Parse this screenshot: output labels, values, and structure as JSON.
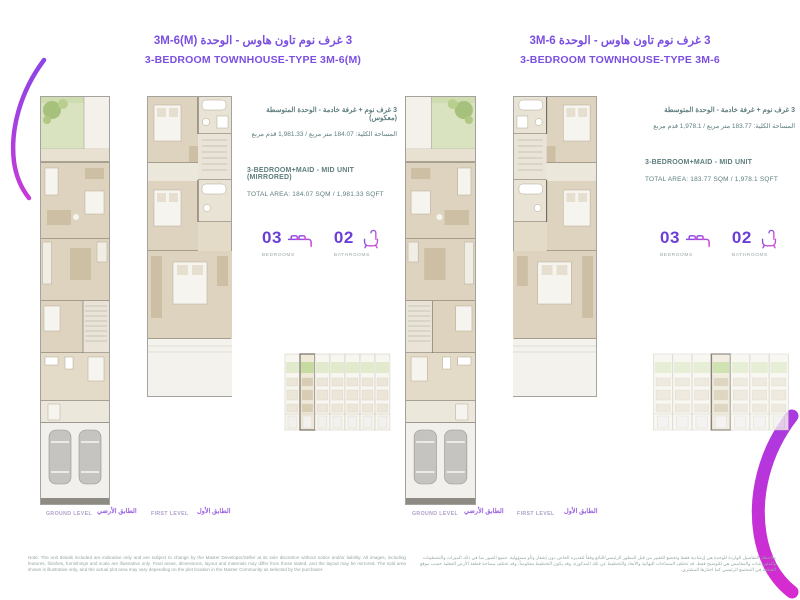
{
  "units": [
    {
      "side": "left",
      "title_ar": "3 غرف نوم تاون هاوس - الوحدة 3M-6(M)",
      "title_en": "3-BEDROOM TOWNHOUSE-TYPE 3M-6(M)",
      "type_ar": "3 غرف نوم + غرفة خادمة - الوحدة المتوسطة (معكوس)",
      "area_ar": "المساحة الكلية: 184.07 متر مربع / 1,981.33 قدم مربع",
      "type_en": "3-BEDROOM+MAID - MID UNIT (MIRRORED)",
      "area_en": "TOTAL AREA: 184.07 SQM / 1,981.33 SQFT",
      "bedrooms_count": "03",
      "bedrooms_label": "BEDROOMS",
      "bathrooms_count": "02",
      "bathrooms_label": "BATHROOMS",
      "ground_level_en": "GROUND LEVEL",
      "ground_level_ar": "الطابق الأرضي",
      "first_level_en": "FIRST LEVEL",
      "first_level_ar": "الطابق الأول"
    },
    {
      "side": "right",
      "title_ar": "3 غرف نوم تاون هاوس - الوحدة 3M-6",
      "title_en": "3-BEDROOM TOWNHOUSE-TYPE 3M-6",
      "type_ar": "3 غرف نوم + غرفة خادمة - الوحدة المتوسطة",
      "area_ar": "المساحة الكلية: 183.77 متر مربع / 1,978.1 قدم مربع",
      "type_en": "3-BEDROOM+MAID - MID UNIT",
      "area_en": "TOTAL AREA: 183.77 SQM / 1,978.1 SQFT",
      "bedrooms_count": "03",
      "bedrooms_label": "BEDROOMS",
      "bathrooms_count": "02",
      "bathrooms_label": "BATHROOMS",
      "ground_level_en": "GROUND LEVEL",
      "ground_level_ar": "الطابق الأرضي",
      "first_level_en": "FIRST LEVEL",
      "first_level_ar": "الطابق الأول"
    }
  ],
  "disclaimer_en": "Note: The unit details included are indicative only and are subject to change by the Master Developer/Seller at its sole discretion without notice and/or liability. All images, including features, finishes, furnishings and scale are illustrative only. Final areas, dimensions, layout and materials may differ from those stated, and the layout may be mirrored. The sold area shown is illustrative only, and the actual plot area may vary depending on the plot location in the Master Community as selected by the purchaser.",
  "disclaimer_ar": "ملاحظة: التفاصيل الواردة للوحدة هي إرشادية فقط وتخضع للتغيير من قبل المطور الرئيسي/البائع وفقاً لتقديره الخاص دون إشعار و/أو مسؤولية. جميع الصور بما في ذلك الميزات والتشطيبات والمفروشات والمقاييس هي للتوضيح فقط. قد تختلف المساحات النهائية والأبعاد والتخطيط عن تلك المذكورة، وقد يكون التخطيط معكوساً، وقد تختلف مساحة قطعة الأرض الفعلية حسب موقع القطعة في المجتمع الرئيسي كما اختارها المشتري.",
  "icons": {
    "bedrooms": "bed-icon",
    "bathrooms": "bathtub-icon"
  },
  "colors": {
    "title_purple": "#7b4fe0",
    "stat_purple": "#6b3fd6",
    "info_teal": "#5e7d7d",
    "label_gray": "#9aa8a8",
    "level_ar_purple": "#9a63e0",
    "brush_magenta": "#d62bd0",
    "plan_beige": "#ddd3bf",
    "garden_green": "#d9e3c0"
  }
}
